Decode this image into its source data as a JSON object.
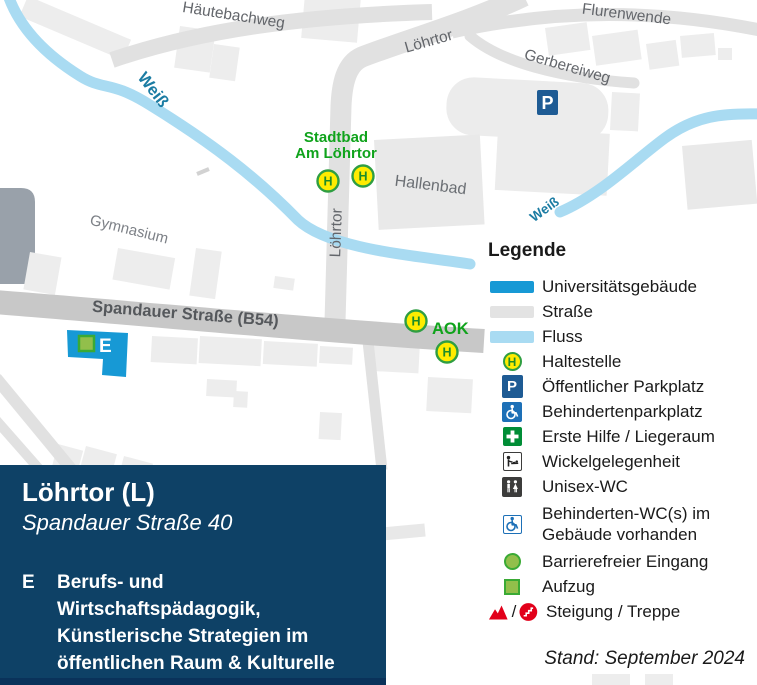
{
  "map": {
    "street_labels": {
      "hautebachweg": "Häutebachweg",
      "flurenwende": "Flurenwende",
      "lohrtor_top": "Löhrtor",
      "lohrtor_vertical": "Löhrtor",
      "gerbereiweg": "Gerbereiweg",
      "spandauer_strasse": "Spandauer Straße (B54)"
    },
    "place_labels": {
      "gymnasium": "Gymnasium",
      "hallenbad": "Hallenbad"
    },
    "river_label": "Weiß",
    "bus_stops": {
      "stadtbad_line1": "Stadtbad",
      "stadtbad_line2": "Am Löhrtor",
      "aok": "AOK"
    },
    "building_label": "E"
  },
  "icons": {
    "h": "H",
    "p": "P"
  },
  "legend": {
    "title": "Legende",
    "slash": "/",
    "items": [
      {
        "icon": "university-swatch",
        "label": "Universitätsgebäude"
      },
      {
        "icon": "street-swatch",
        "label": "Straße"
      },
      {
        "icon": "river-swatch",
        "label": "Fluss"
      },
      {
        "icon": "bus-stop-icon",
        "label": "Haltestelle"
      },
      {
        "icon": "parking-icon",
        "label": "Öffentlicher Parkplatz"
      },
      {
        "icon": "accessible-parking-icon",
        "label": "Behindertenparkplatz"
      },
      {
        "icon": "first-aid-icon",
        "label": "Erste Hilfe / Liegeraum"
      },
      {
        "icon": "baby-change-icon",
        "label": "Wickelgelegenheit"
      },
      {
        "icon": "unisex-wc-icon",
        "label": "Unisex-WC"
      },
      {
        "icon": "accessible-wc-icon",
        "label": "Behinderten-WC(s) im Gebäude vorhanden"
      },
      {
        "icon": "accessible-entrance-icon",
        "label": "Barrierefreier Eingang"
      },
      {
        "icon": "elevator-icon",
        "label": "Aufzug"
      },
      {
        "icon": "slope-stairs-icons",
        "label": "Steigung / Treppe"
      }
    ],
    "stand": "Stand: September 2024"
  },
  "infobox": {
    "title": "Löhrtor (L)",
    "subtitle": "Spandauer Straße 40",
    "entry_key": "E",
    "entry_lines": [
      "Berufs- und Wirtschaftspädagogik,",
      "Künstlerische Strategien im",
      "öffentlichen Raum & Kulturelle",
      "Bildung, Kunstgeschichte"
    ]
  },
  "colors": {
    "university_blue": "#1799d5",
    "river_blue": "#a9dbf2",
    "street_gray": "#e3e3e3",
    "main_street_gray": "#c8c8c8",
    "infobox_navy": "#0e4166",
    "stop_green": "#10a31c",
    "access_green": "#3aaa35",
    "access_green_fill": "#92bf4b",
    "signal_red": "#e2001a",
    "h_yellow": "#ffec00",
    "parking_navy": "#1e5b94"
  }
}
